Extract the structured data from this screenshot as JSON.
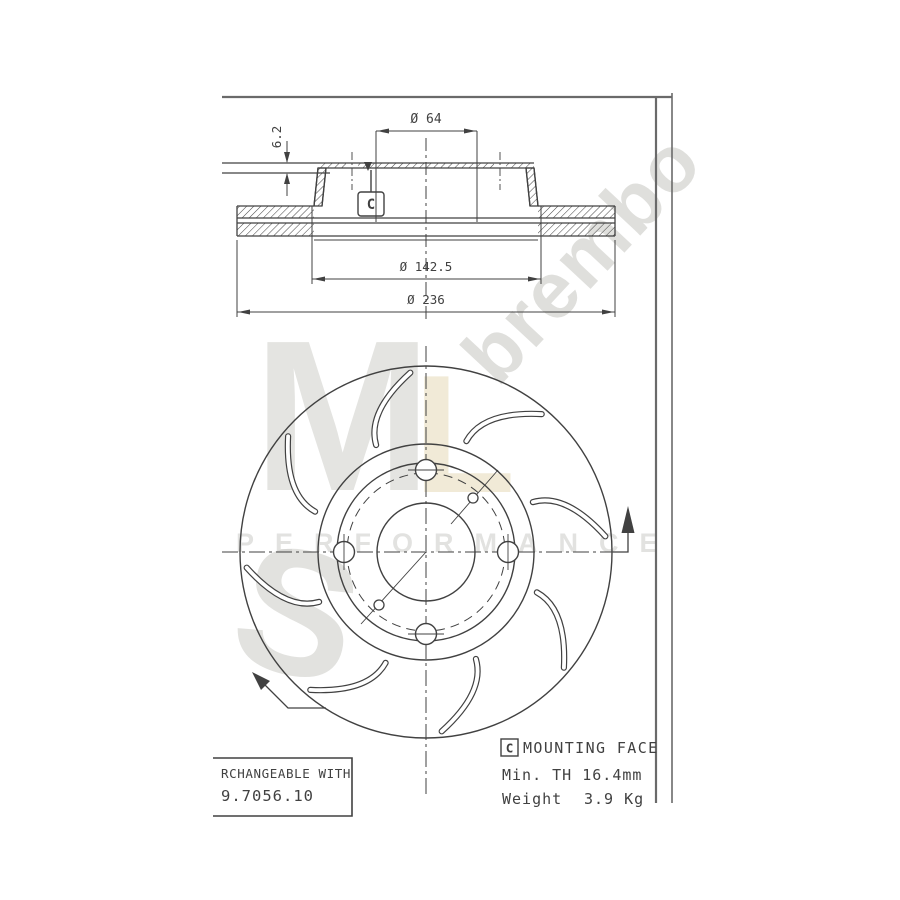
{
  "watermark": {
    "letter_m": "M",
    "letter_l": "L",
    "letter_s": "S",
    "performance": "PERFORMANCE",
    "brand": "brembo"
  },
  "section_view": {
    "dim_bore": "Ø 64",
    "dim_step": "6.2",
    "dim_flange": "Ø 142.5",
    "dim_outer": "Ø 236",
    "datum": "C"
  },
  "footer": {
    "interchange_title": "RCHANGEABLE WITH",
    "interchange_part": "9.7056.10",
    "datum": "C",
    "mounting_face": "MOUNTING FACE",
    "min_thickness": "Min. TH 16.4mm",
    "weight_label": "Weight",
    "weight_value": "3.9 Kg"
  },
  "colors": {
    "line": "#414141",
    "frame": "#6a6a6a",
    "watermark_gray": "#e3e3e0",
    "watermark_cream": "#f0e9d6",
    "watermark_text": "#d9d9d6"
  }
}
